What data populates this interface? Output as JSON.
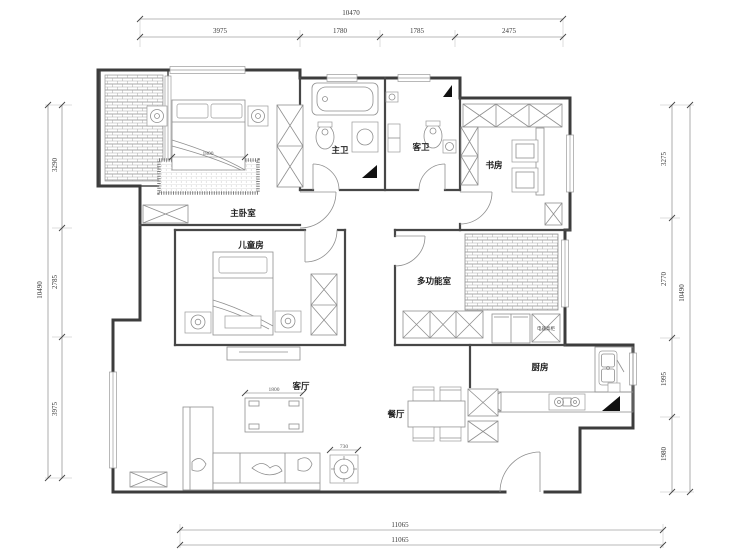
{
  "plan": {
    "labels": {
      "master_bedroom": "主卧室",
      "kids_room": "儿童房",
      "master_bath": "主卫",
      "guest_bath": "客卫",
      "study": "书房",
      "multi_room": "多功能室",
      "kitchen": "厨房",
      "dining": "餐厅",
      "living": "客厅",
      "appliance_cabinet": "电器高柜"
    },
    "furniture_dims": {
      "master_bed": "1800",
      "coffee_table": "1800",
      "side_table": "730"
    }
  },
  "dimensions": {
    "top": {
      "total": "10470",
      "segments": [
        "3975",
        "1780",
        "1785",
        "2475"
      ]
    },
    "left": {
      "total": "10490",
      "segments": [
        "3290",
        "2785",
        "3975"
      ]
    },
    "right": {
      "total": "10490",
      "segments": [
        "3275",
        "2770",
        "1995",
        "1980"
      ]
    },
    "bottom": {
      "segments": [
        "11065",
        "11065"
      ]
    }
  }
}
